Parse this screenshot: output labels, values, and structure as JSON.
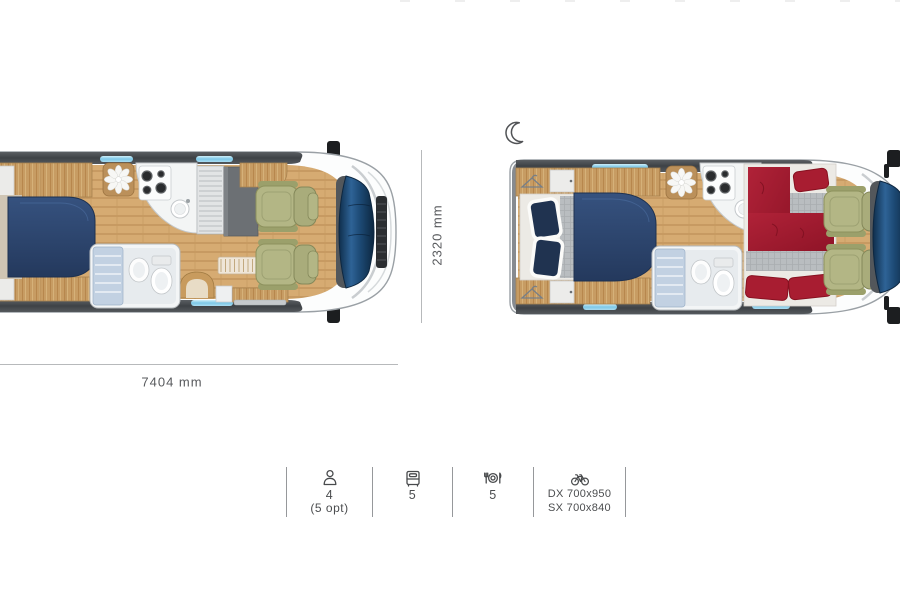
{
  "scene": {
    "description": "Motorhome top-view floorplans, day and night layout",
    "layouts": [
      {
        "id": "day",
        "name": "day-layout"
      },
      {
        "id": "night",
        "name": "night-layout",
        "icon": "crescent-moon-icon"
      }
    ]
  },
  "dimensions": {
    "length": "7404 mm",
    "width": "2320 mm"
  },
  "specs": [
    {
      "id": "occupants",
      "icon": "person-icon",
      "value": "4",
      "note": "(5 opt)"
    },
    {
      "id": "sleeping-places",
      "icon": "bed-icon",
      "value": "5"
    },
    {
      "id": "dining-places",
      "icon": "table-setting-icon",
      "value": "5"
    },
    {
      "id": "garage-bike",
      "icon": "bicycle-icon",
      "line1": "DX 700x950",
      "line2": "SX 700x840"
    }
  ],
  "colors": {
    "wood": "#c99f66",
    "bed_navy": "#2b3f63",
    "bed_red": "#a51d31",
    "seat_green": "#b2b584",
    "glass_blue": "#1d4669",
    "window_cyan": "#8fd4ef",
    "text": "#4c4e50",
    "dimension_line": "#b7b9bb"
  }
}
